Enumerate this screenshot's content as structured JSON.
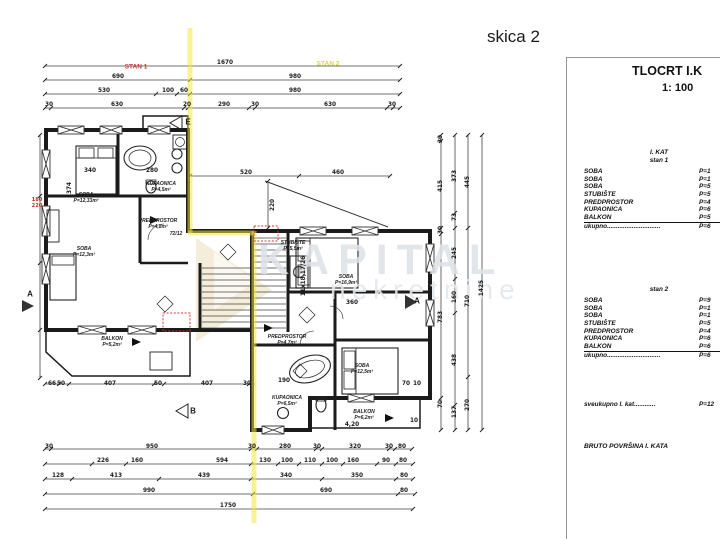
{
  "sketch_title": "skica 2",
  "panel": {
    "title": "TLOCRT I.K",
    "scale": "1: 100",
    "floor_header": "I. KAT",
    "stan1": {
      "header": "stan 1",
      "rows": [
        {
          "name": "SOBA",
          "value": "P=1"
        },
        {
          "name": "SOBA",
          "value": "P=1"
        },
        {
          "name": "SOBA",
          "value": "P=5"
        },
        {
          "name": "STUBIŠTE",
          "value": "P=5"
        },
        {
          "name": "PREDPROSTOR",
          "value": "P=4"
        },
        {
          "name": "KUPAONICA",
          "value": "P=6"
        },
        {
          "name": "BALKON",
          "value": "P=5"
        },
        {
          "name": "ukupno..............................",
          "value": "P=6"
        }
      ]
    },
    "stan2": {
      "header": "stan 2",
      "rows": [
        {
          "name": "SOBA",
          "value": "P=9"
        },
        {
          "name": "SOBA",
          "value": "P=1"
        },
        {
          "name": "SOBA",
          "value": "P=1"
        },
        {
          "name": "STUBIŠTE",
          "value": "P=5"
        },
        {
          "name": "PREDPROSTOR",
          "value": "P=4"
        },
        {
          "name": "KUPAONICA",
          "value": "P=6"
        },
        {
          "name": "BALKON",
          "value": "P=6"
        },
        {
          "name": "ukupno..............................",
          "value": "P=6"
        }
      ]
    },
    "grand_total": {
      "name": "sveukupno I. kat............",
      "value": "P=12"
    },
    "bruto_label": "BRUTO POVRŠINA I. KATA"
  },
  "watermark": {
    "line1": "KAPITAL",
    "line2": "nekretnine"
  },
  "colors": {
    "highlight_yellow": "#f2e63c",
    "stan1_label_red": "#cc3b35",
    "stan2_label_yellow": "#ddd23b",
    "watermark_gray": "#dde2e7"
  },
  "plan_labels": [
    {
      "t": "1670",
      "x": 225,
      "y": 63
    },
    {
      "t": "690",
      "x": 118,
      "y": 77
    },
    {
      "t": "980",
      "x": 295,
      "y": 77
    },
    {
      "t": "530",
      "x": 104,
      "y": 91
    },
    {
      "t": "100",
      "x": 168,
      "y": 91
    },
    {
      "t": "60",
      "x": 184,
      "y": 91
    },
    {
      "t": "980",
      "x": 295,
      "y": 91
    },
    {
      "t": "30",
      "x": 49,
      "y": 105
    },
    {
      "t": "630",
      "x": 117,
      "y": 105
    },
    {
      "t": "20",
      "x": 187,
      "y": 105
    },
    {
      "t": "290",
      "x": 224,
      "y": 105
    },
    {
      "t": "30",
      "x": 255,
      "y": 105
    },
    {
      "t": "630",
      "x": 330,
      "y": 105
    },
    {
      "t": "30",
      "x": 392,
      "y": 105
    },
    {
      "t": "520",
      "x": 246,
      "y": 173
    },
    {
      "t": "460",
      "x": 338,
      "y": 173
    },
    {
      "t": "220",
      "x": 273,
      "y": 205,
      "c": "dv"
    },
    {
      "t": "STAN 1",
      "x": 136,
      "y": 67,
      "c": "red",
      "n": "stan1-label"
    },
    {
      "t": "STAN 2",
      "x": 328,
      "y": 64,
      "c": "yel",
      "n": "stan2-label"
    },
    {
      "t": "340",
      "x": 90,
      "y": 171
    },
    {
      "t": "280",
      "x": 152,
      "y": 171
    },
    {
      "t": "SOBA",
      "x": 86,
      "y": 195,
      "c": "rm",
      "n": "room-label"
    },
    {
      "t": "P=12,33m²",
      "x": 86,
      "y": 201,
      "c": "rm",
      "n": "room-area"
    },
    {
      "t": "KUPAONICA",
      "x": 161,
      "y": 184,
      "c": "rm",
      "n": "room-label"
    },
    {
      "t": "P=4,5m²",
      "x": 161,
      "y": 190,
      "c": "rm",
      "n": "room-area"
    },
    {
      "t": "PREDPROSTOR",
      "x": 158,
      "y": 221,
      "c": "rm",
      "n": "room-label"
    },
    {
      "t": "P=4,8m²",
      "x": 158,
      "y": 227,
      "c": "rm",
      "n": "room-area"
    },
    {
      "t": "72/12",
      "x": 176,
      "y": 234,
      "c": "rm"
    },
    {
      "t": "SOBA",
      "x": 84,
      "y": 249,
      "c": "rm",
      "n": "room-label"
    },
    {
      "t": "P=12,3m²",
      "x": 84,
      "y": 255,
      "c": "rm",
      "n": "room-area"
    },
    {
      "t": "180",
      "x": 37,
      "y": 200,
      "c": "redsm"
    },
    {
      "t": "220",
      "x": 37,
      "y": 206,
      "c": "redsm"
    },
    {
      "t": "374",
      "x": 70,
      "y": 188,
      "c": "dv"
    },
    {
      "t": "BALKON",
      "x": 112,
      "y": 339,
      "c": "rm",
      "n": "room-label"
    },
    {
      "t": "P=5,2m²",
      "x": 112,
      "y": 345,
      "c": "rm",
      "n": "room-area"
    },
    {
      "t": "66",
      "x": 52,
      "y": 384
    },
    {
      "t": "50",
      "x": 61,
      "y": 384
    },
    {
      "t": "407",
      "x": 110,
      "y": 384
    },
    {
      "t": "50",
      "x": 158,
      "y": 384
    },
    {
      "t": "407",
      "x": 207,
      "y": 384
    },
    {
      "t": "30",
      "x": 247,
      "y": 384
    },
    {
      "t": "STUBIŠTE",
      "x": 293,
      "y": 243,
      "c": "rm",
      "n": "room-label"
    },
    {
      "t": "P=5,5m²",
      "x": 293,
      "y": 249,
      "c": "rm",
      "n": "room-area"
    },
    {
      "t": "11x18,17/26",
      "x": 304,
      "y": 276,
      "c": "dv"
    },
    {
      "t": "SOBA",
      "x": 346,
      "y": 277,
      "c": "rm",
      "n": "room-label"
    },
    {
      "t": "P=16,9m²",
      "x": 346,
      "y": 283,
      "c": "rm",
      "n": "room-area"
    },
    {
      "t": "360",
      "x": 352,
      "y": 303
    },
    {
      "t": "PREDPROSTOR",
      "x": 287,
      "y": 337,
      "c": "rm",
      "n": "room-label"
    },
    {
      "t": "P=4,7m²",
      "x": 287,
      "y": 343,
      "c": "rm",
      "n": "room-area"
    },
    {
      "t": "190",
      "x": 284,
      "y": 381
    },
    {
      "t": "KUPAONICA",
      "x": 287,
      "y": 398,
      "c": "rm",
      "n": "room-label"
    },
    {
      "t": "P=6,5m²",
      "x": 287,
      "y": 404,
      "c": "rm",
      "n": "room-area"
    },
    {
      "t": "SOBA",
      "x": 362,
      "y": 366,
      "c": "rm",
      "n": "room-label"
    },
    {
      "t": "P=12,5m²",
      "x": 362,
      "y": 372,
      "c": "rm",
      "n": "room-area"
    },
    {
      "t": "BALKON",
      "x": 364,
      "y": 412,
      "c": "rm",
      "n": "room-label"
    },
    {
      "t": "P=6,2m²",
      "x": 364,
      "y": 418,
      "c": "rm",
      "n": "room-area"
    },
    {
      "t": "4,20",
      "x": 352,
      "y": 425
    },
    {
      "t": "70",
      "x": 406,
      "y": 384
    },
    {
      "t": "10",
      "x": 417,
      "y": 384
    },
    {
      "t": "10",
      "x": 414,
      "y": 421
    },
    {
      "t": "30",
      "x": 49,
      "y": 447
    },
    {
      "t": "950",
      "x": 152,
      "y": 447
    },
    {
      "t": "30",
      "x": 252,
      "y": 447
    },
    {
      "t": "280",
      "x": 285,
      "y": 447
    },
    {
      "t": "30",
      "x": 317,
      "y": 447
    },
    {
      "t": "320",
      "x": 355,
      "y": 447
    },
    {
      "t": "30",
      "x": 389,
      "y": 447
    },
    {
      "t": "80",
      "x": 402,
      "y": 447
    },
    {
      "t": "226",
      "x": 103,
      "y": 461
    },
    {
      "t": "160",
      "x": 137,
      "y": 461
    },
    {
      "t": "594",
      "x": 222,
      "y": 461
    },
    {
      "t": "130",
      "x": 265,
      "y": 461
    },
    {
      "t": "100",
      "x": 287,
      "y": 461
    },
    {
      "t": "110",
      "x": 310,
      "y": 461
    },
    {
      "t": "100",
      "x": 332,
      "y": 461
    },
    {
      "t": "160",
      "x": 353,
      "y": 461
    },
    {
      "t": "90",
      "x": 386,
      "y": 461
    },
    {
      "t": "80",
      "x": 403,
      "y": 461
    },
    {
      "t": "128",
      "x": 58,
      "y": 476
    },
    {
      "t": "413",
      "x": 116,
      "y": 476
    },
    {
      "t": "439",
      "x": 204,
      "y": 476
    },
    {
      "t": "340",
      "x": 286,
      "y": 476
    },
    {
      "t": "350",
      "x": 357,
      "y": 476
    },
    {
      "t": "80",
      "x": 404,
      "y": 476
    },
    {
      "t": "990",
      "x": 149,
      "y": 491
    },
    {
      "t": "690",
      "x": 326,
      "y": 491
    },
    {
      "t": "80",
      "x": 404,
      "y": 491
    },
    {
      "t": "1750",
      "x": 228,
      "y": 506
    },
    {
      "t": "30",
      "x": 441,
      "y": 139,
      "c": "dv"
    },
    {
      "t": "415",
      "x": 441,
      "y": 186,
      "c": "dv"
    },
    {
      "t": "30",
      "x": 441,
      "y": 230,
      "c": "dv"
    },
    {
      "t": "783",
      "x": 441,
      "y": 317,
      "c": "dv"
    },
    {
      "t": "70",
      "x": 441,
      "y": 404,
      "c": "dv"
    },
    {
      "t": "373",
      "x": 455,
      "y": 176,
      "c": "dv"
    },
    {
      "t": "73",
      "x": 455,
      "y": 217,
      "c": "dv"
    },
    {
      "t": "245",
      "x": 455,
      "y": 253,
      "c": "dv"
    },
    {
      "t": "160",
      "x": 455,
      "y": 297,
      "c": "dv"
    },
    {
      "t": "438",
      "x": 455,
      "y": 360,
      "c": "dv"
    },
    {
      "t": "137",
      "x": 455,
      "y": 412,
      "c": "dv"
    },
    {
      "t": "445",
      "x": 468,
      "y": 182,
      "c": "dv"
    },
    {
      "t": "710",
      "x": 468,
      "y": 301,
      "c": "dv"
    },
    {
      "t": "270",
      "x": 468,
      "y": 405,
      "c": "dv"
    },
    {
      "t": "1425",
      "x": 482,
      "y": 288,
      "c": "dv"
    },
    {
      "t": "E",
      "x": 188,
      "y": 122,
      "c": "mk",
      "n": "section-marker-e"
    },
    {
      "t": "B",
      "x": 193,
      "y": 411,
      "c": "mk",
      "n": "section-marker-b"
    },
    {
      "t": "A",
      "x": 30,
      "y": 294,
      "c": "mk",
      "n": "section-marker-a"
    },
    {
      "t": "A",
      "x": 417,
      "y": 301,
      "c": "mk",
      "n": "section-marker-a"
    }
  ]
}
